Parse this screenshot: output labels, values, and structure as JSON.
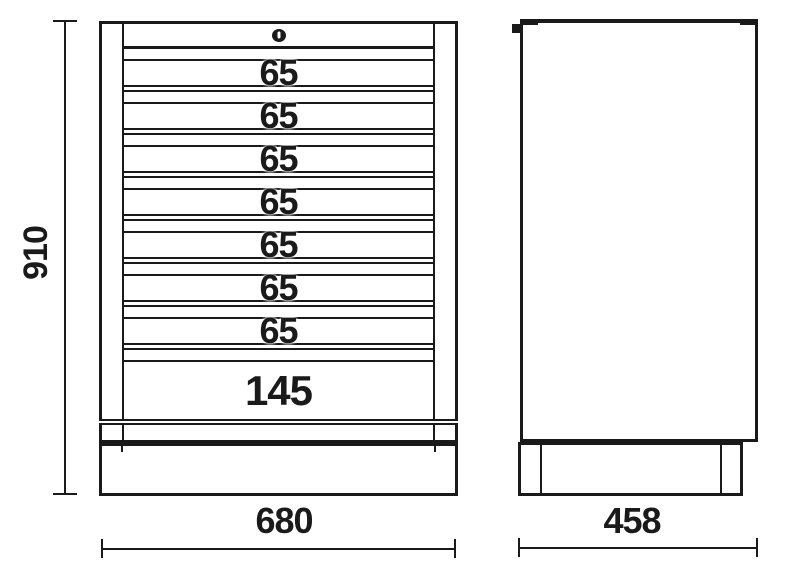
{
  "drawing": {
    "subject": "drawer tool cabinet technical drawing",
    "views": [
      "front view",
      "side view"
    ]
  },
  "front_view": {
    "lock_icon": "keyhole-lock",
    "drawers": [
      {
        "label": "65"
      },
      {
        "label": "65"
      },
      {
        "label": "65"
      },
      {
        "label": "65"
      },
      {
        "label": "65"
      },
      {
        "label": "65"
      },
      {
        "label": "65"
      },
      {
        "label": "145"
      }
    ]
  },
  "dimensions": {
    "overall_height": {
      "value": "910"
    },
    "front_width": {
      "value": "680"
    },
    "side_depth": {
      "value": "458"
    }
  },
  "colors": {
    "line": "#1a1a1a",
    "background": "#ffffff"
  }
}
